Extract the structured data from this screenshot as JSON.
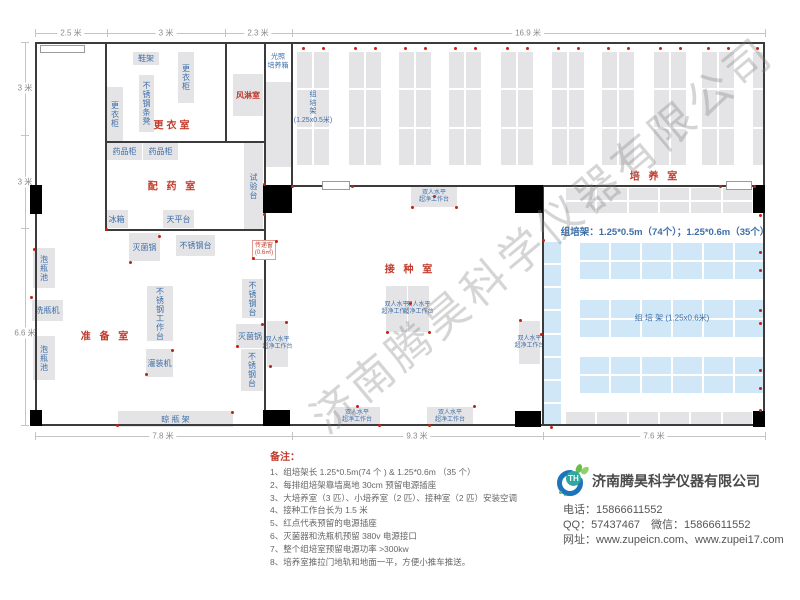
{
  "watermark": "济南腾昊科学仪器有限公司",
  "notes": {
    "title": "备注：",
    "items": [
      "1、组培架长 1.25*0.5m(74 个 ) & 1.25*0.6m （35 个）",
      "2、每排组培架靠墙离地 30cm 预留电源插座",
      "3、大培养室（3 匹）、小培养室（2 匹）、接种室（2 匹）安装空调",
      "4、接种工作台长为 1.5 米",
      "5、红点代表预留的电源插座",
      "6、灭菌器和洗瓶机预留 380v 电源接口",
      "7、整个组培室预留电源功率 >300kw",
      "8、培养室推拉门地轨和地面一平，方便小推车推送。"
    ]
  },
  "company": {
    "logo_text": "TH",
    "name": "济南腾昊科学仪器有限公司",
    "phone": "电话：15866611552",
    "qq_wechat": "QQ：57437467　微信：15866611552",
    "web": "网址：www.zupeicn.com、www.zupei17.com"
  },
  "floor": {
    "bench_lines": [
      "双人水平",
      "超净工作台"
    ],
    "walls": [
      [
        35,
        42,
        730,
        2
      ],
      [
        35,
        424,
        730,
        2
      ],
      [
        35,
        42,
        2,
        384
      ],
      [
        763,
        42,
        2,
        384
      ],
      [
        105,
        42,
        2,
        189
      ],
      [
        225,
        42,
        2,
        101
      ],
      [
        105,
        141,
        160,
        2
      ],
      [
        264,
        42,
        2,
        384
      ],
      [
        291,
        42,
        2,
        145
      ],
      [
        291,
        185,
        474,
        2
      ],
      [
        105,
        229,
        161,
        2
      ],
      [
        542,
        185,
        2,
        241
      ]
    ],
    "doors": [
      [
        40,
        45,
        45,
        8
      ],
      [
        322,
        181,
        28,
        9
      ],
      [
        726,
        181,
        26,
        9
      ]
    ],
    "columns": [
      [
        30,
        185,
        12,
        29
      ],
      [
        30,
        410,
        12,
        16
      ],
      [
        263,
        185,
        29,
        28
      ],
      [
        263,
        410,
        27,
        16
      ],
      [
        515,
        185,
        28,
        28
      ],
      [
        515,
        411,
        26,
        16
      ],
      [
        753,
        185,
        12,
        28
      ],
      [
        753,
        411,
        12,
        16
      ]
    ],
    "furniture": [
      {
        "n": "shoe-rack",
        "t": "鞋架",
        "type": "h",
        "x": 133,
        "y": 52,
        "w": 26,
        "h": 13
      },
      {
        "n": "locker-cabinet",
        "t": "更衣柜",
        "type": "v",
        "x": 178,
        "y": 52,
        "w": 16,
        "h": 51
      },
      {
        "n": "stainless-bench",
        "t": "不锈钢条凳",
        "type": "v",
        "x": 139,
        "y": 75,
        "w": 15,
        "h": 57
      },
      {
        "n": "locker-cabinet",
        "t": "更衣柜",
        "type": "v",
        "x": 107,
        "y": 87,
        "w": 16,
        "h": 54
      },
      {
        "n": "air-shower-room",
        "t": "风淋室",
        "type": "h-red",
        "x": 233,
        "y": 74,
        "w": 30,
        "h": 42
      },
      {
        "n": "light-incubator-box",
        "t": "",
        "type": "plain",
        "x": 266,
        "y": 82,
        "w": 25,
        "h": 85
      },
      {
        "n": "medicine-cabinet",
        "t": "药品柜",
        "type": "h",
        "x": 107,
        "y": 143,
        "w": 35,
        "h": 17
      },
      {
        "n": "medicine-cabinet",
        "t": "药品柜",
        "type": "h",
        "x": 143,
        "y": 143,
        "w": 35,
        "h": 17
      },
      {
        "n": "test-bench",
        "t": "试验台",
        "type": "v",
        "x": 244,
        "y": 143,
        "w": 19,
        "h": 86
      },
      {
        "n": "fridge",
        "t": "冰箱",
        "type": "h",
        "x": 105,
        "y": 210,
        "w": 23,
        "h": 18
      },
      {
        "n": "balance-table",
        "t": "天平台",
        "type": "h",
        "x": 163,
        "y": 210,
        "w": 31,
        "h": 18
      },
      {
        "n": "sterilizer-pot",
        "t": "灭菌锅",
        "type": "h",
        "x": 129,
        "y": 233,
        "w": 31,
        "h": 28
      },
      {
        "n": "stainless-table",
        "t": "不锈钢台",
        "type": "h",
        "x": 176,
        "y": 235,
        "w": 39,
        "h": 21
      },
      {
        "n": "bottle-soak-pool",
        "t": "泡瓶池",
        "type": "v",
        "x": 33,
        "y": 248,
        "w": 22,
        "h": 40
      },
      {
        "n": "bottle-washer",
        "t": "洗瓶机",
        "type": "h",
        "x": 32,
        "y": 300,
        "w": 31,
        "h": 21
      },
      {
        "n": "bottle-soak-pool",
        "t": "泡瓶池",
        "type": "v",
        "x": 33,
        "y": 336,
        "w": 22,
        "h": 44
      },
      {
        "n": "stainless-worktable",
        "t": "不锈钢工作台",
        "type": "v",
        "x": 147,
        "y": 286,
        "w": 26,
        "h": 55
      },
      {
        "n": "filling-machine",
        "t": "灌装机",
        "type": "h",
        "x": 146,
        "y": 349,
        "w": 27,
        "h": 28
      },
      {
        "n": "stainless-table",
        "t": "不锈钢台",
        "type": "v",
        "x": 242,
        "y": 279,
        "w": 21,
        "h": 39
      },
      {
        "n": "sterilizer-pot",
        "t": "灭菌锅",
        "type": "h",
        "x": 236,
        "y": 324,
        "w": 28,
        "h": 24
      },
      {
        "n": "stainless-table",
        "t": "不锈钢台",
        "type": "v",
        "x": 241,
        "y": 349,
        "w": 22,
        "h": 42
      },
      {
        "n": "bottle-drying-rack",
        "t": "晾  瓶  架",
        "type": "h",
        "x": 118,
        "y": 411,
        "w": 115,
        "h": 16
      },
      {
        "n": "clean-bench",
        "type": "bench",
        "x": 411,
        "y": 186,
        "w": 46,
        "h": 21
      },
      {
        "n": "clean-bench",
        "type": "bench",
        "x": 267,
        "y": 321,
        "w": 21,
        "h": 46
      },
      {
        "n": "clean-bench",
        "type": "bench",
        "x": 386,
        "y": 286,
        "w": 21,
        "h": 46
      },
      {
        "n": "clean-bench",
        "type": "bench",
        "x": 408,
        "y": 286,
        "w": 21,
        "h": 46
      },
      {
        "n": "clean-bench",
        "type": "bench",
        "x": 519,
        "y": 321,
        "w": 21,
        "h": 43
      },
      {
        "n": "clean-bench",
        "type": "bench",
        "x": 334,
        "y": 407,
        "w": 46,
        "h": 19
      },
      {
        "n": "clean-bench",
        "type": "bench",
        "x": 427,
        "y": 407,
        "w": 46,
        "h": 19
      }
    ],
    "transfer_window": {
      "x": 252,
      "y": 240,
      "w": 24,
      "h": 20,
      "l1": "传递窗",
      "l2": "(0.6㎡)"
    },
    "racks": [
      {
        "x": 297,
        "y": 52,
        "w": 32,
        "h": 113,
        "rows": 3,
        "cols": 2,
        "fill": "gray"
      },
      {
        "x": 349,
        "y": 52,
        "w": 32,
        "h": 113,
        "rows": 3,
        "cols": 2,
        "fill": "gray"
      },
      {
        "x": 399,
        "y": 52,
        "w": 32,
        "h": 113,
        "rows": 3,
        "cols": 2,
        "fill": "gray"
      },
      {
        "x": 449,
        "y": 52,
        "w": 32,
        "h": 113,
        "rows": 3,
        "cols": 2,
        "fill": "gray"
      },
      {
        "x": 501,
        "y": 52,
        "w": 32,
        "h": 113,
        "rows": 3,
        "cols": 2,
        "fill": "gray"
      },
      {
        "x": 552,
        "y": 52,
        "w": 32,
        "h": 113,
        "rows": 3,
        "cols": 2,
        "fill": "gray"
      },
      {
        "x": 602,
        "y": 52,
        "w": 32,
        "h": 113,
        "rows": 3,
        "cols": 2,
        "fill": "gray"
      },
      {
        "x": 654,
        "y": 52,
        "w": 32,
        "h": 113,
        "rows": 3,
        "cols": 2,
        "fill": "gray"
      },
      {
        "x": 702,
        "y": 52,
        "w": 32,
        "h": 113,
        "rows": 3,
        "cols": 2,
        "fill": "gray"
      },
      {
        "x": 753,
        "y": 52,
        "w": 12,
        "h": 113,
        "rows": 3,
        "cols": 1,
        "fill": "gray"
      },
      {
        "x": 566,
        "y": 188,
        "w": 186,
        "h": 25,
        "rows": 2,
        "cols": 6,
        "fill": "gray"
      },
      {
        "x": 566,
        "y": 412,
        "w": 186,
        "h": 13,
        "rows": 1,
        "cols": 6,
        "fill": "gray"
      },
      {
        "x": 544,
        "y": 242,
        "w": 17,
        "h": 183,
        "rows": 8,
        "cols": 1,
        "fill": "blue"
      },
      {
        "x": 580,
        "y": 243,
        "w": 184,
        "h": 36,
        "rows": 2,
        "cols": 6,
        "fill": "blue"
      },
      {
        "x": 580,
        "y": 300,
        "w": 184,
        "h": 37,
        "rows": 2,
        "cols": 6,
        "fill": "blue"
      },
      {
        "x": 580,
        "y": 357,
        "w": 184,
        "h": 36,
        "rows": 2,
        "cols": 6,
        "fill": "blue"
      }
    ],
    "labels": [
      {
        "t": "更衣室",
        "cx": 173,
        "cy": 124,
        "cls": "room"
      },
      {
        "t": "配 药 室",
        "cx": 173,
        "cy": 185,
        "cls": "room"
      },
      {
        "t": "准 备 室",
        "cx": 106,
        "cy": 335,
        "cls": "room"
      },
      {
        "t": "接 种 室",
        "cx": 410,
        "cy": 268,
        "cls": "room"
      },
      {
        "t": "培 养 室",
        "cx": 655,
        "cy": 175,
        "cls": "room"
      },
      {
        "t": "光照\n培养箱",
        "cx": 278,
        "cy": 62,
        "cls": "blues"
      },
      {
        "t": "组\n培\n架\n(1.25x0.5米)",
        "cx": 313,
        "cy": 108,
        "cls": "blues"
      },
      {
        "t": "组  培  架 (1.25x0.6米)",
        "cx": 672,
        "cy": 318,
        "cls": "bluem"
      },
      {
        "t": "组培架：1.25*0.5m（74个）；1.25*0.6m（35个）",
        "cx": 665,
        "cy": 231,
        "cls": "spec"
      }
    ],
    "sockets": [
      [
        303,
        48
      ],
      [
        323,
        48
      ],
      [
        355,
        48
      ],
      [
        375,
        48
      ],
      [
        405,
        48
      ],
      [
        425,
        48
      ],
      [
        455,
        48
      ],
      [
        475,
        48
      ],
      [
        507,
        48
      ],
      [
        527,
        48
      ],
      [
        558,
        48
      ],
      [
        578,
        48
      ],
      [
        608,
        48
      ],
      [
        628,
        48
      ],
      [
        660,
        48
      ],
      [
        680,
        48
      ],
      [
        708,
        48
      ],
      [
        728,
        48
      ],
      [
        757,
        48
      ],
      [
        760,
        215
      ],
      [
        760,
        252
      ],
      [
        760,
        270
      ],
      [
        760,
        310
      ],
      [
        760,
        323
      ],
      [
        760,
        370
      ],
      [
        760,
        388
      ],
      [
        760,
        410
      ],
      [
        412,
        207
      ],
      [
        456,
        207
      ],
      [
        434,
        196
      ],
      [
        410,
        303
      ],
      [
        387,
        332
      ],
      [
        429,
        332
      ],
      [
        520,
        320
      ],
      [
        541,
        334
      ],
      [
        357,
        406
      ],
      [
        379,
        425
      ],
      [
        429,
        425
      ],
      [
        474,
        406
      ],
      [
        286,
        322
      ],
      [
        270,
        366
      ],
      [
        31,
        297
      ],
      [
        34,
        249
      ],
      [
        146,
        374
      ],
      [
        172,
        350
      ],
      [
        237,
        346
      ],
      [
        262,
        324
      ],
      [
        130,
        262
      ],
      [
        159,
        236
      ],
      [
        117,
        425
      ],
      [
        232,
        412
      ],
      [
        106,
        229
      ],
      [
        253,
        258
      ],
      [
        276,
        241
      ],
      [
        264,
        184
      ],
      [
        264,
        214
      ],
      [
        292,
        186
      ],
      [
        352,
        186
      ],
      [
        543,
        240
      ],
      [
        720,
        186
      ],
      [
        754,
        186
      ],
      [
        551,
        427
      ]
    ],
    "dims": {
      "top": {
        "y": 33,
        "x1": 35,
        "x2": 765,
        "ticks": [
          35,
          107,
          225,
          292,
          765
        ],
        "labels": [
          {
            "t": "2.5 米",
            "p": 71
          },
          {
            "t": "3 米",
            "p": 166
          },
          {
            "t": "2.3 米",
            "p": 258
          },
          {
            "t": "16.9 米",
            "p": 528
          }
        ]
      },
      "left": {
        "x": 25,
        "y1": 42,
        "y2": 425,
        "ticks": [
          42,
          135,
          228,
          425
        ],
        "labels": [
          {
            "t": "3 米",
            "p": 88
          },
          {
            "t": "3 米",
            "p": 182
          },
          {
            "t": "6.6 米",
            "p": 333
          }
        ]
      },
      "bottom": {
        "y": 436,
        "x1": 35,
        "x2": 765,
        "ticks": [
          35,
          292,
          543,
          765
        ],
        "labels": [
          {
            "t": "7.8 米",
            "p": 163
          },
          {
            "t": "9.3 米",
            "p": 417
          },
          {
            "t": "7.6 米",
            "p": 654
          }
        ]
      }
    }
  }
}
